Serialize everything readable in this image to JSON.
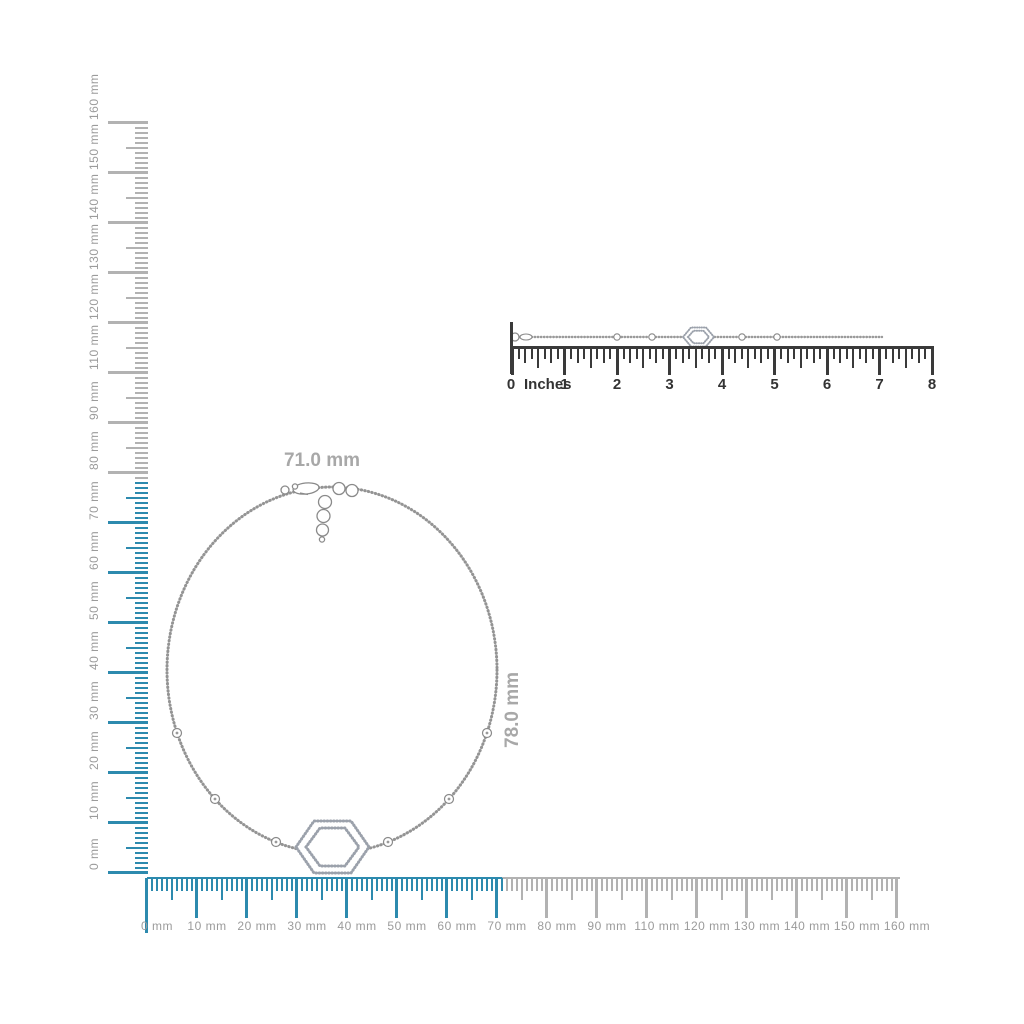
{
  "measurements": {
    "width_label": "71.0 mm",
    "height_label": "78.0 mm"
  },
  "vertical_ruler": {
    "labels": [
      "160 mm",
      "150 mm",
      "140 mm",
      "130 mm",
      "120 mm",
      "110 mm",
      "90 mm",
      "80 mm",
      "70 mm",
      "60 mm",
      "50 mm",
      "40 mm",
      "30 mm",
      "20 mm",
      "10 mm",
      "0 mm"
    ]
  },
  "horizontal_ruler": {
    "labels": [
      "0 mm",
      "10 mm",
      "20 mm",
      "30 mm",
      "40 mm",
      "50 mm",
      "60 mm",
      "70 mm",
      "80 mm",
      "90 mm",
      "110 mm",
      "120 mm",
      "130 mm",
      "140 mm",
      "150 mm",
      "160 mm"
    ]
  },
  "inches_ruler": {
    "zero_label": "0",
    "unit_label": "Inches",
    "number_labels": [
      "1",
      "2",
      "3",
      "4",
      "5",
      "6",
      "7",
      "8"
    ]
  },
  "colors": {
    "highlight_blue": "#2d8aae",
    "ruler_gray": "#b2b2b2",
    "label_gray": "#9b9b9b",
    "inches_dark": "#3a3a3a",
    "measurement_gray": "#a8a8a8",
    "chain_gray": "#949494",
    "pave_gray": "#9ba1ab"
  }
}
